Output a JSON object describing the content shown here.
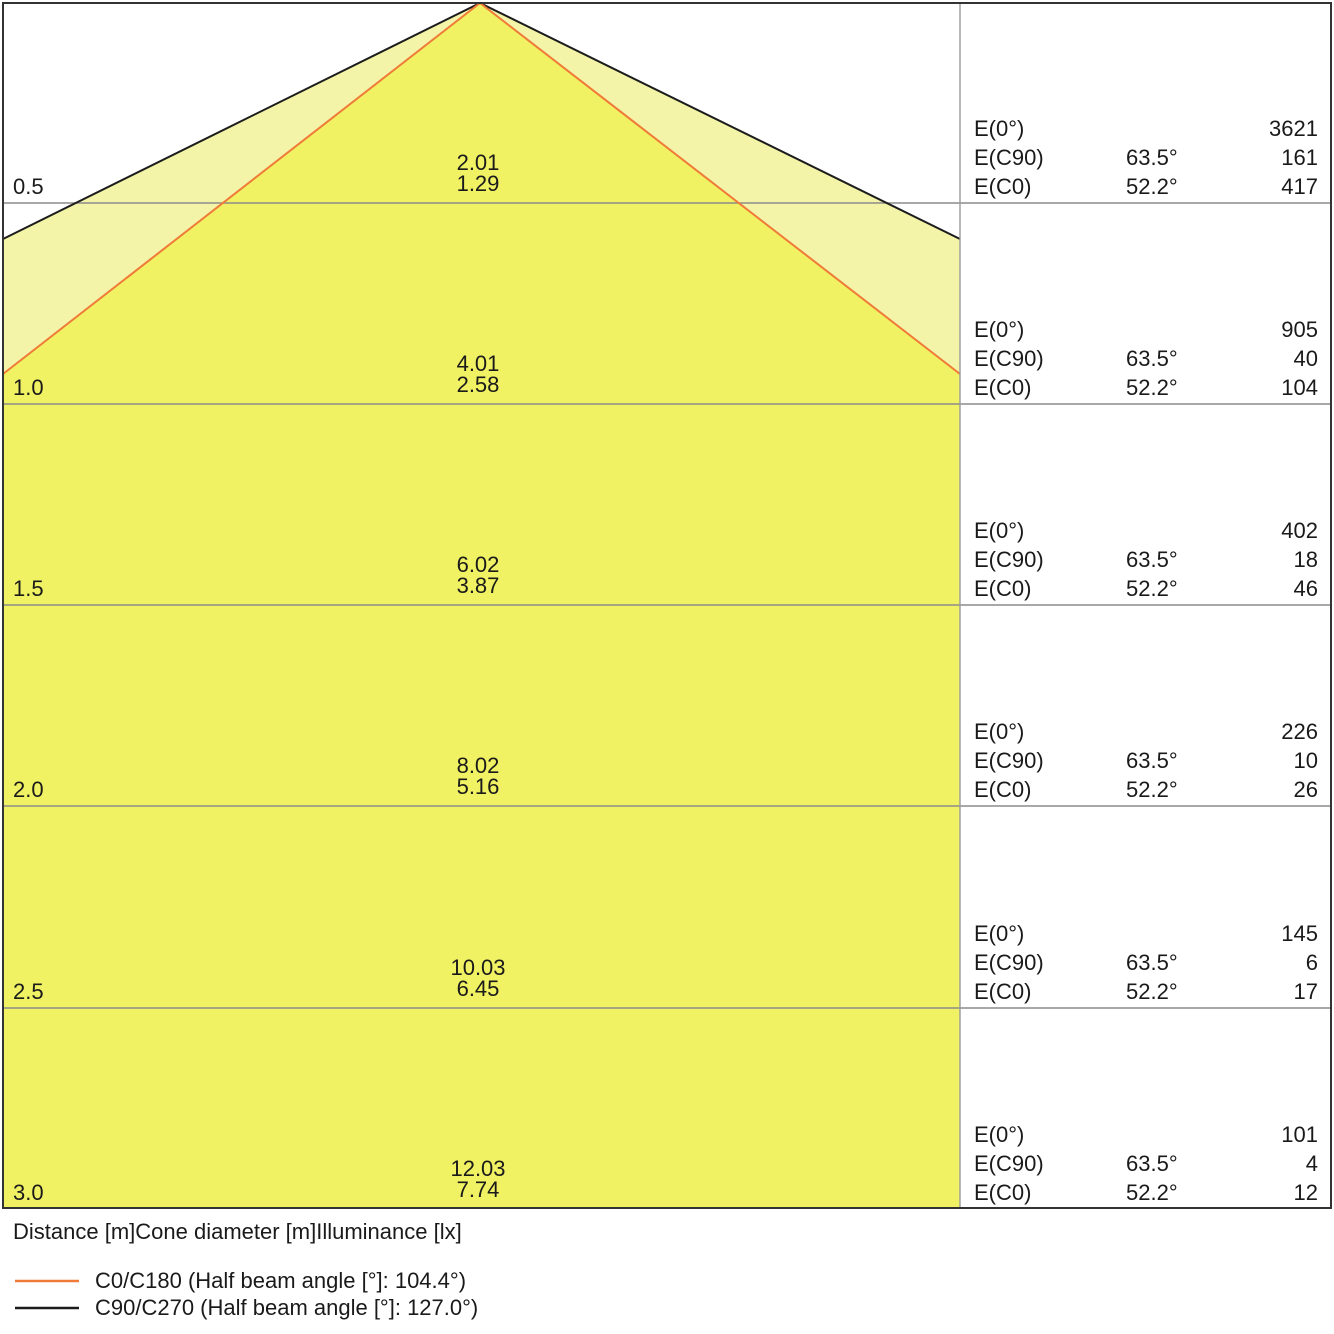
{
  "title": "Luminaire light cone diagram",
  "rows": [
    {
      "distance": "0.5",
      "cone_c90": "2.01",
      "cone_c0": "1.29",
      "e0": "3621",
      "ec90_angle": "63.5°",
      "ec90": "161",
      "ec0_angle": "52.2°",
      "ec0": "417"
    },
    {
      "distance": "1.0",
      "cone_c90": "4.01",
      "cone_c0": "2.58",
      "e0": "905",
      "ec90_angle": "63.5°",
      "ec90": "40",
      "ec0_angle": "52.2°",
      "ec0": "104"
    },
    {
      "distance": "1.5",
      "cone_c90": "6.02",
      "cone_c0": "3.87",
      "e0": "402",
      "ec90_angle": "63.5°",
      "ec90": "18",
      "ec0_angle": "52.2°",
      "ec0": "46"
    },
    {
      "distance": "2.0",
      "cone_c90": "8.02",
      "cone_c0": "5.16",
      "e0": "226",
      "ec90_angle": "63.5°",
      "ec90": "10",
      "ec0_angle": "52.2°",
      "ec0": "26"
    },
    {
      "distance": "2.5",
      "cone_c90": "10.03",
      "cone_c0": "6.45",
      "e0": "145",
      "ec90_angle": "63.5°",
      "ec90": "6",
      "ec0_angle": "52.2°",
      "ec0": "17"
    },
    {
      "distance": "3.0",
      "cone_c90": "12.03",
      "cone_c0": "7.74",
      "e0": "101",
      "ec90_angle": "63.5°",
      "ec90": "4",
      "ec0_angle": "52.2°",
      "ec0": "12"
    }
  ],
  "table_labels": {
    "e0": "E(0°)",
    "ec90": "E(C90)",
    "ec0": "E(C0)"
  },
  "footer": {
    "axis_label": "Distance [m]Cone diameter [m]Illuminance [lx]"
  },
  "legend": [
    {
      "label": "C0/C180 (Half beam angle [°]: 104.4°)",
      "color": "#f07a38"
    },
    {
      "label": "C90/C270 (Half beam angle [°]: 127.0°)",
      "color": "#1c1c1c"
    }
  ],
  "colors": {
    "outer_cone_fill": "#f3f4a8",
    "inner_cone_fill": "#f0f163",
    "c90_line": "#1c1c1c",
    "c0_line": "#f07a38"
  },
  "chart_data": {
    "type": "area",
    "title": "Light cone diagram: cone diameter and illuminance vs distance",
    "xlabel": "Distance [m]Cone diameter [m]Illuminance [lx]",
    "distances_m": [
      0.5,
      1.0,
      1.5,
      2.0,
      2.5,
      3.0
    ],
    "series": [
      {
        "name": "C0/C180 (Half beam angle [°]: 104.4°)",
        "half_beam_angle_deg": 104.4,
        "evaluation_angle_deg": 52.2,
        "cone_diameter_m": [
          1.29,
          2.58,
          3.87,
          5.16,
          6.45,
          7.74
        ],
        "illuminance_lx": [
          417,
          104,
          46,
          26,
          17,
          12
        ],
        "color": "#f07a38"
      },
      {
        "name": "C90/C270 (Half beam angle [°]: 127.0°)",
        "half_beam_angle_deg": 127.0,
        "evaluation_angle_deg": 63.5,
        "cone_diameter_m": [
          2.01,
          4.01,
          6.02,
          8.02,
          10.03,
          12.03
        ],
        "illuminance_lx": [
          161,
          40,
          18,
          10,
          6,
          4
        ],
        "color": "#1c1c1c"
      },
      {
        "name": "E(0°)",
        "illuminance_lx": [
          3621,
          905,
          402,
          226,
          145,
          101
        ]
      }
    ],
    "legend_position": "bottom",
    "grid": true
  }
}
